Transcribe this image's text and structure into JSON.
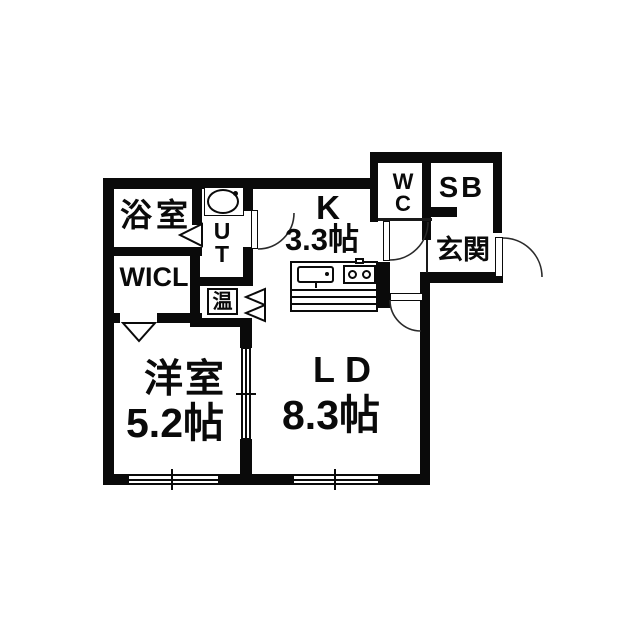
{
  "title": "floor-plan",
  "colors": {
    "wall": "#0a0a0a",
    "background": "#ffffff"
  },
  "rooms": {
    "bathroom": {
      "label": "浴室"
    },
    "wicl": {
      "label": "WICL"
    },
    "utility": {
      "letters": [
        "U",
        "T"
      ]
    },
    "water_heater": {
      "label": "温"
    },
    "kitchen": {
      "label": "K",
      "size": "3.3帖"
    },
    "wc": {
      "letters": [
        "W",
        "C"
      ]
    },
    "shoe_box": {
      "label": "SB"
    },
    "entrance": {
      "label": "玄関"
    },
    "western_room": {
      "label": "洋室",
      "size": "5.2帖"
    },
    "living_dining": {
      "label": "LD",
      "size": "8.3帖"
    }
  },
  "symbols": {
    "sink": "wash-basin-oval",
    "kitchen_counter": "sink-and-two-burner-stove",
    "doors": [
      "hinged-door-arc",
      "folding-door-triangle",
      "sliding-door",
      "entrance-door-arc"
    ],
    "windows": [
      "sliding-window",
      "sliding-window"
    ]
  }
}
